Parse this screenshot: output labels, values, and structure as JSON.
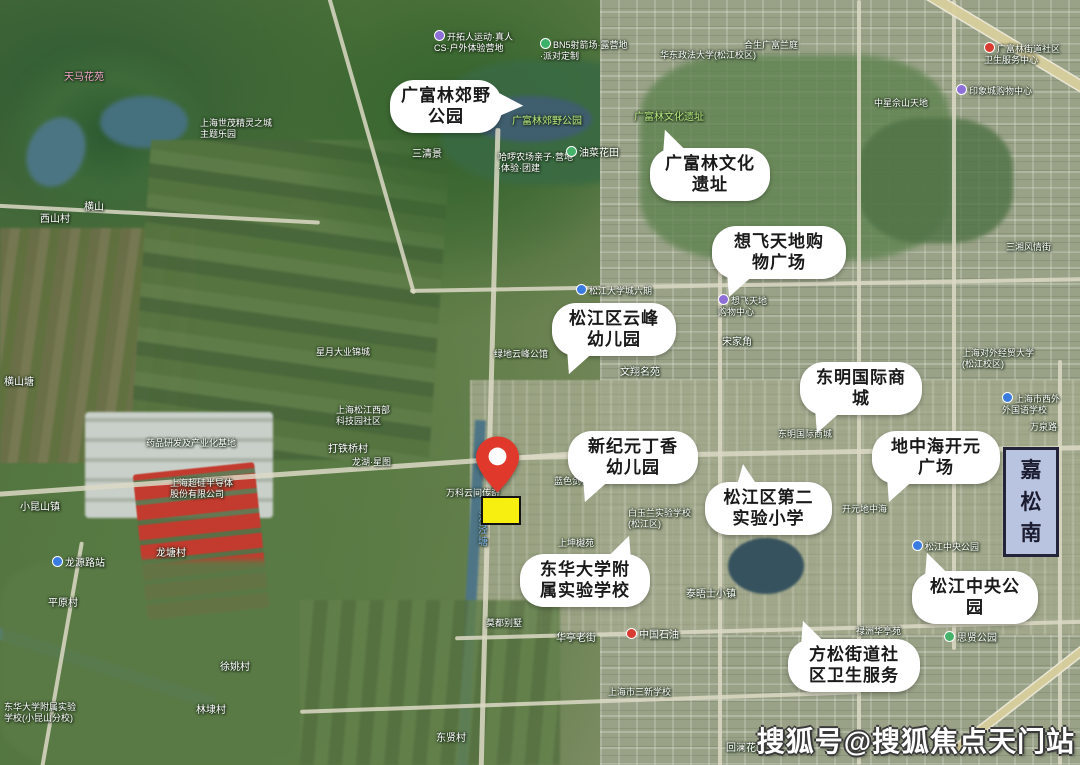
{
  "colors": {
    "pin": "#e0392b",
    "highlight": "#f6ef0f",
    "plate": "#b9c4e0",
    "bubble": "#ffffff",
    "callout_text": "#1a1a1a"
  },
  "watermark": {
    "text": "搜狐号@搜狐焦点天门站"
  },
  "road_plate": {
    "chars": [
      "嘉",
      "松",
      "南"
    ]
  },
  "callouts": [
    {
      "lines": [
        "广富林郊野",
        "公园"
      ],
      "x": 390,
      "y": 80,
      "w": 100,
      "tail": "right"
    },
    {
      "lines": [
        "广富林文化",
        "遗址"
      ],
      "x": 650,
      "y": 148,
      "w": 108,
      "tail": "top-left"
    },
    {
      "lines": [
        "想飞天地购",
        "物广场"
      ],
      "x": 712,
      "y": 226,
      "w": 122,
      "tail": "bottom-left"
    },
    {
      "lines": [
        "松江区云峰",
        "幼儿园"
      ],
      "x": 552,
      "y": 303,
      "w": 112,
      "tail": "bottom-left"
    },
    {
      "lines": [
        "东明国际商",
        "城"
      ],
      "x": 800,
      "y": 362,
      "w": 110,
      "tail": "bottom-left"
    },
    {
      "lines": [
        "新纪元丁香",
        "幼儿园"
      ],
      "x": 568,
      "y": 431,
      "w": 118,
      "tail": "bottom-left"
    },
    {
      "lines": [
        "地中海开元",
        "广场"
      ],
      "x": 872,
      "y": 431,
      "w": 116,
      "tail": "bottom-left"
    },
    {
      "lines": [
        "松江区第二",
        "实验小学"
      ],
      "x": 705,
      "y": 482,
      "w": 115,
      "tail": "top"
    },
    {
      "lines": [
        "东华大学附",
        "属实验学校"
      ],
      "x": 520,
      "y": 554,
      "w": 118,
      "tail": "top-right"
    },
    {
      "lines": [
        "松江中央公",
        "园"
      ],
      "x": 912,
      "y": 571,
      "w": 114,
      "tail": "top-left"
    },
    {
      "lines": [
        "方松街道社",
        "区卫生服务"
      ],
      "x": 788,
      "y": 639,
      "w": 120,
      "tail": "top-left"
    }
  ],
  "map_labels": [
    {
      "text": "天马花苑",
      "x": 64,
      "y": 72,
      "color": "#f0a6c8"
    },
    {
      "text": "上海世茂精灵之城\n主题乐园",
      "x": 200,
      "y": 118,
      "s": 9
    },
    {
      "text": "横山",
      "x": 84,
      "y": 202
    },
    {
      "text": "西山村",
      "x": 40,
      "y": 214
    },
    {
      "text": "横山塘",
      "x": 4,
      "y": 377
    },
    {
      "text": "小昆山镇",
      "x": 20,
      "y": 502
    },
    {
      "text": "龙源路站",
      "x": 52,
      "y": 556,
      "dot": "#3a7be0"
    },
    {
      "text": "平原村",
      "x": 48,
      "y": 598
    },
    {
      "text": "东华大学附属实验\n学校(小昆山分校)",
      "x": 4,
      "y": 702,
      "s": 9
    },
    {
      "text": "徐姚村",
      "x": 220,
      "y": 662
    },
    {
      "text": "林埭村",
      "x": 196,
      "y": 705
    },
    {
      "text": "龙塘村",
      "x": 156,
      "y": 548
    },
    {
      "text": "药品研发及产业化基地",
      "x": 146,
      "y": 438,
      "s": 9
    },
    {
      "text": "上海超硅半导体\n股份有限公司",
      "x": 170,
      "y": 478,
      "s": 9
    },
    {
      "text": "打铁桥村",
      "x": 328,
      "y": 444
    },
    {
      "text": "龙湖·星图",
      "x": 352,
      "y": 457,
      "s": 9
    },
    {
      "text": "上海松江西部\n科技园社区",
      "x": 336,
      "y": 405,
      "s": 9
    },
    {
      "text": "星月大业锦城",
      "x": 316,
      "y": 347,
      "s": 9
    },
    {
      "text": "三清景",
      "x": 412,
      "y": 149
    },
    {
      "text": "开拓人运动·真人\nCS·户外体验营地",
      "x": 434,
      "y": 30,
      "s": 9,
      "dot": "#8e6fd8"
    },
    {
      "text": "BN5射箭场·露营地\n·派对定制",
      "x": 540,
      "y": 38,
      "s": 9,
      "dot": "#3db06a"
    },
    {
      "text": "广富林郊野公园",
      "x": 512,
      "y": 116,
      "color": "#b7e77f"
    },
    {
      "text": "哈啰农场亲子·营地\n·体验·团建",
      "x": 498,
      "y": 152,
      "s": 9
    },
    {
      "text": "油菜花田",
      "x": 566,
      "y": 146,
      "dot": "#46b36a"
    },
    {
      "text": "华东政法大学(松江校区)",
      "x": 660,
      "y": 50,
      "s": 9
    },
    {
      "text": "合生广富兰庭",
      "x": 744,
      "y": 40,
      "s": 9
    },
    {
      "text": "广富林文化遗址",
      "x": 634,
      "y": 112,
      "color": "#b7e77f"
    },
    {
      "text": "松江大学城六期",
      "x": 576,
      "y": 284,
      "s": 9,
      "dot": "#3a7be0"
    },
    {
      "text": "绿地云峰公馆",
      "x": 494,
      "y": 349,
      "s": 9
    },
    {
      "text": "文翔名苑",
      "x": 620,
      "y": 367
    },
    {
      "text": "宋家角",
      "x": 722,
      "y": 337
    },
    {
      "text": "想飞天地\n购物中心",
      "x": 718,
      "y": 294,
      "s": 9,
      "dot": "#8e6fd8"
    },
    {
      "text": "上海对外经贸大学\n(松江校区)",
      "x": 962,
      "y": 348,
      "s": 9
    },
    {
      "text": "上海市西外\n外国语学校",
      "x": 1002,
      "y": 392,
      "s": 9,
      "dot": "#3a7be0"
    },
    {
      "text": "三湘风情街",
      "x": 1006,
      "y": 242,
      "s": 9
    },
    {
      "text": "中国石油",
      "x": 626,
      "y": 628,
      "dot": "#d83c30"
    },
    {
      "text": "华亭老街",
      "x": 556,
      "y": 633
    },
    {
      "text": "莫都别墅",
      "x": 486,
      "y": 618,
      "s": 9
    },
    {
      "text": "泰晤士小镇",
      "x": 686,
      "y": 589
    },
    {
      "text": "上海市三新学校",
      "x": 608,
      "y": 687,
      "s": 9
    },
    {
      "text": "回澜花园",
      "x": 726,
      "y": 743
    },
    {
      "text": "东贤村",
      "x": 436,
      "y": 733
    },
    {
      "text": "思贤公园",
      "x": 944,
      "y": 631,
      "dot": "#46b36a"
    },
    {
      "text": "松江中央公园",
      "x": 912,
      "y": 540,
      "s": 9,
      "dot": "#3a7be0"
    },
    {
      "text": "开元地中海",
      "x": 842,
      "y": 504,
      "s": 9
    },
    {
      "text": "东明国际商城",
      "x": 778,
      "y": 429,
      "s": 9
    },
    {
      "text": "万科云间传奇",
      "x": 446,
      "y": 488,
      "s": 9
    },
    {
      "text": "蓝色剑桥",
      "x": 554,
      "y": 476,
      "s": 9
    },
    {
      "text": "上坤樾苑",
      "x": 558,
      "y": 538,
      "s": 9
    },
    {
      "text": "白玉兰实验学校\n(松江区)",
      "x": 628,
      "y": 508,
      "s": 9
    },
    {
      "text": "印象城购物中心",
      "x": 956,
      "y": 84,
      "s": 9,
      "dot": "#8e6fd8"
    },
    {
      "text": "中星佘山天地",
      "x": 874,
      "y": 98,
      "s": 9
    },
    {
      "text": "广富林街道社区\n卫生服务中心",
      "x": 984,
      "y": 42,
      "s": 9,
      "dot": "#d83c30"
    },
    {
      "text": "禄洲华亭苑",
      "x": 856,
      "y": 626,
      "s": 9
    },
    {
      "text": "万泉路",
      "x": 1030,
      "y": 422,
      "s": 9
    },
    {
      "text": "沈泾塘",
      "x": 474,
      "y": 512,
      "color": "#7fb2e8",
      "vertical": true
    }
  ]
}
